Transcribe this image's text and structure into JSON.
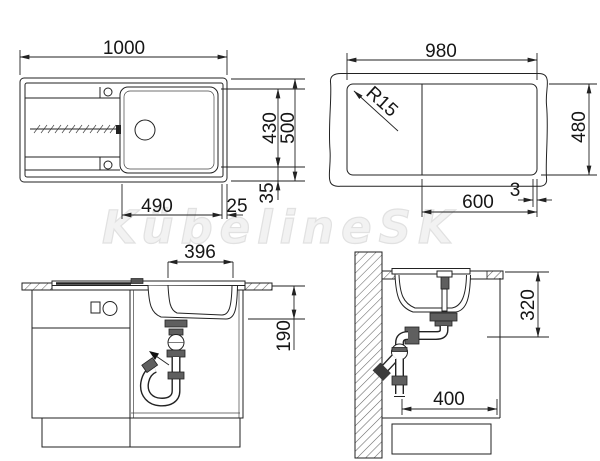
{
  "watermark": "KübelineSK",
  "dims": {
    "plan": {
      "overall_width": "1000",
      "overall_depth": "500",
      "inner_depth": "430",
      "bowl_offset": "490",
      "edge_gap": "25",
      "rim_height": "35"
    },
    "cutout": {
      "width": "980",
      "depth": "480",
      "corner_radius": "R15",
      "bowl_section": "600",
      "edge_offset": "3"
    },
    "front": {
      "bowl_width": "396",
      "bowl_depth": "190"
    },
    "side": {
      "install_depth": "320",
      "cabinet_clearance": "400"
    }
  },
  "colors": {
    "line": "#222222",
    "watermark": "#e1e1e1",
    "background": "#ffffff"
  }
}
